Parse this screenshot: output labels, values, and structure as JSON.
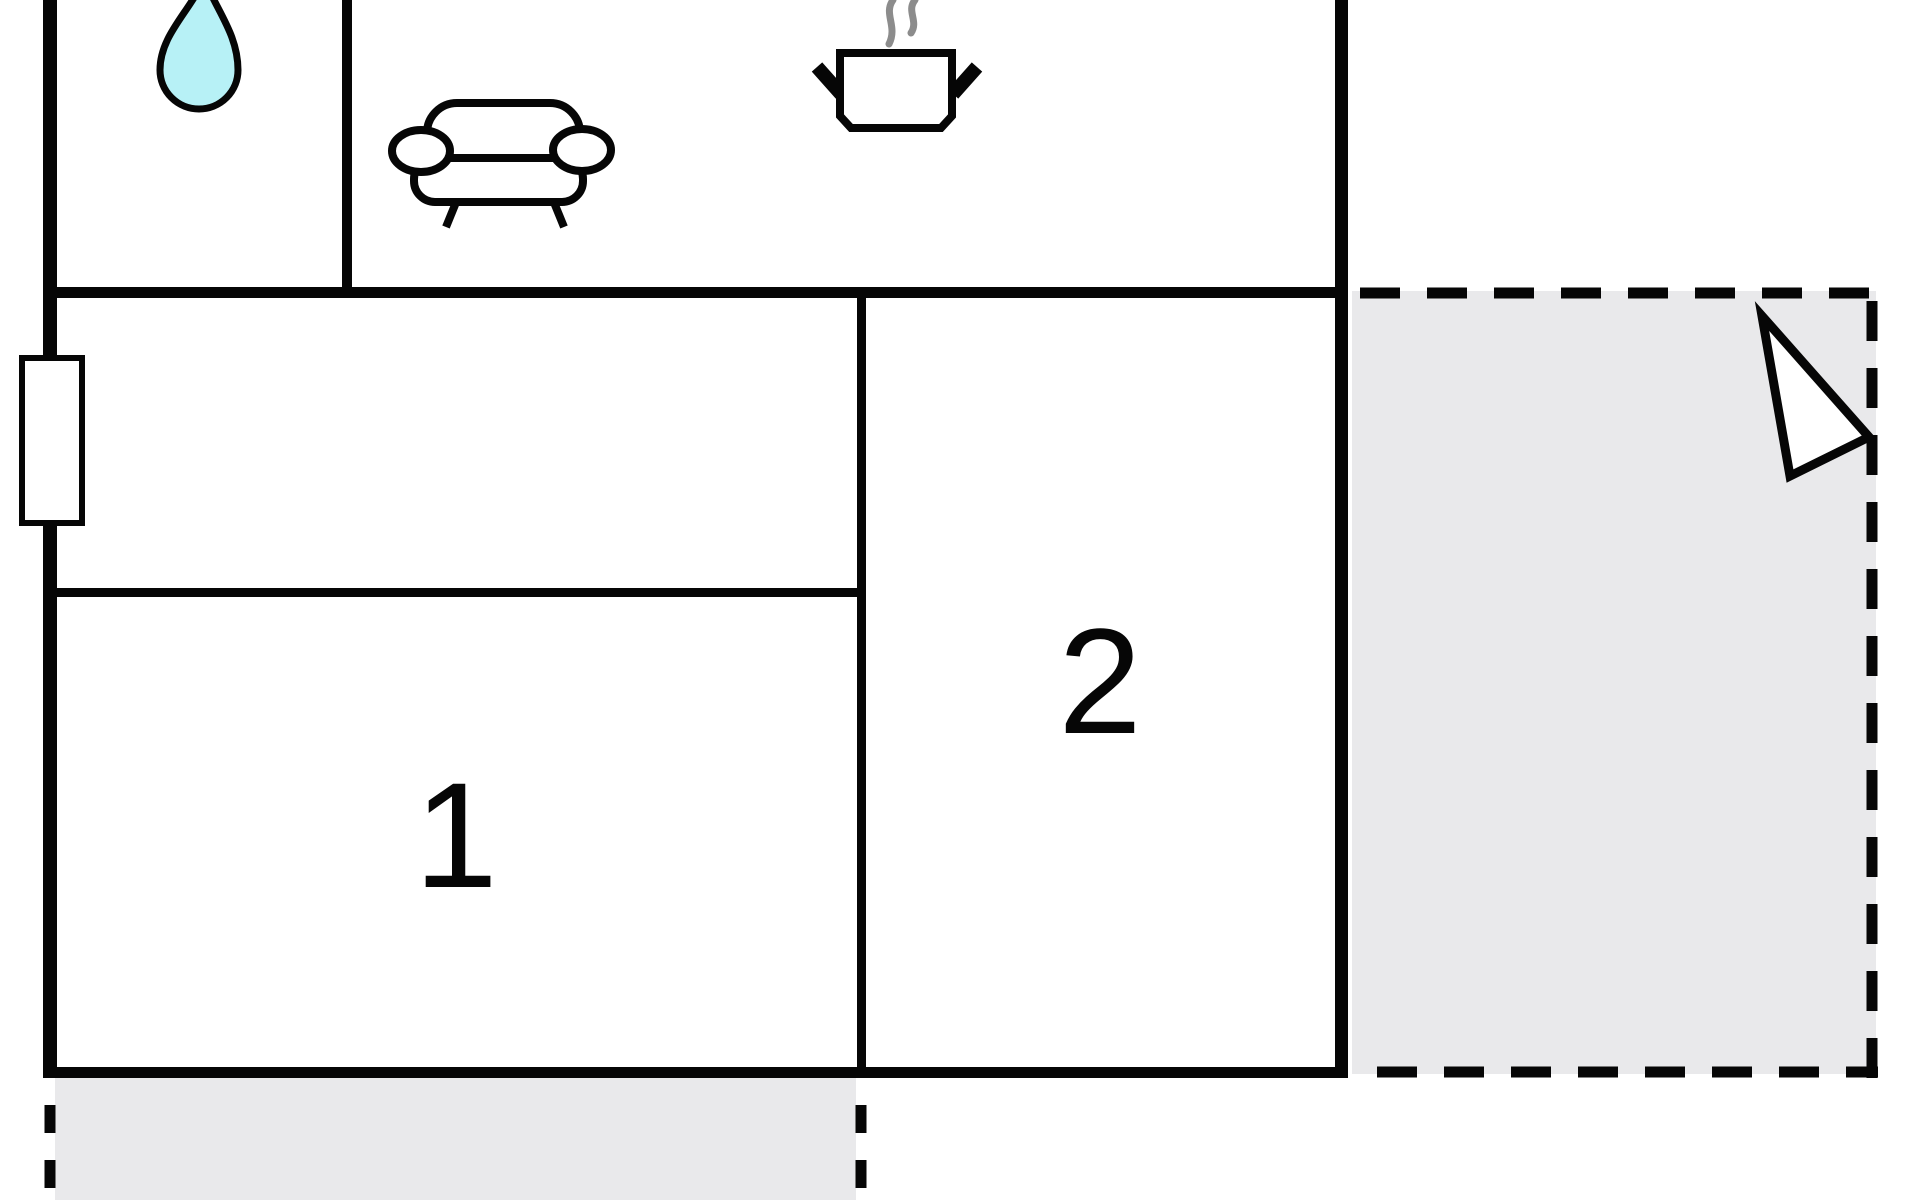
{
  "floor_plan": {
    "labels": {
      "room1": "1",
      "room2": "2"
    },
    "icons": [
      "water-drop-icon",
      "sofa-icon",
      "cooking-pot-icon",
      "north-arrow-icon",
      "window-symbol"
    ]
  },
  "colors": {
    "background": "#ffffff",
    "wall": "#060606",
    "terrace_fill": "#e9e9eb",
    "water_drop_fill": "#b7f1f6",
    "steam": "#8c8c8c",
    "icon_fill": "#ffffff"
  }
}
